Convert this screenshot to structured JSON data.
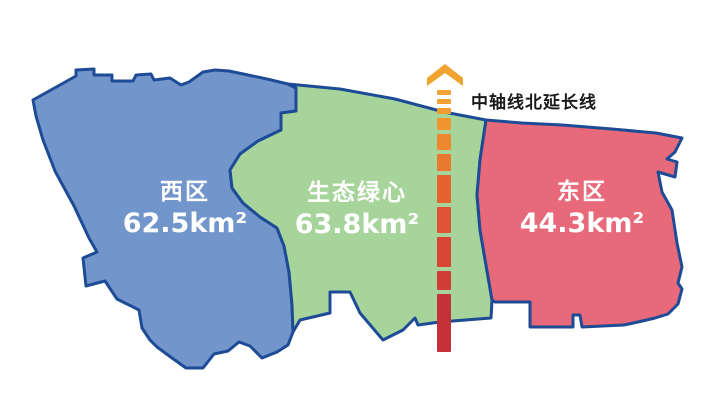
{
  "map": {
    "regions": [
      {
        "name": "西区",
        "area": "62.5km²",
        "color": "#7296CB"
      },
      {
        "name": "生态绿心",
        "area": "63.8km²",
        "color": "#A6D49B"
      },
      {
        "name": "东区",
        "area": "44.3km²",
        "color": "#E7697A"
      }
    ],
    "axis": {
      "label": "中轴线北延长线",
      "arrow_icon": "chevron-up-icon",
      "arrow_color": "#F0A32E",
      "dash_colors": [
        "#F2A439",
        "#F1A034",
        "#F09C30",
        "#EF942F",
        "#ED882E",
        "#EB782F",
        "#E66331",
        "#E05233",
        "#D94434",
        "#D23C36",
        "#C53138"
      ]
    },
    "colors": {
      "outline": "#1E4B96",
      "background": "#FFFFFF",
      "region_label_text": "#FFFFFF",
      "axis_label_text": "#1A1A1A"
    }
  }
}
